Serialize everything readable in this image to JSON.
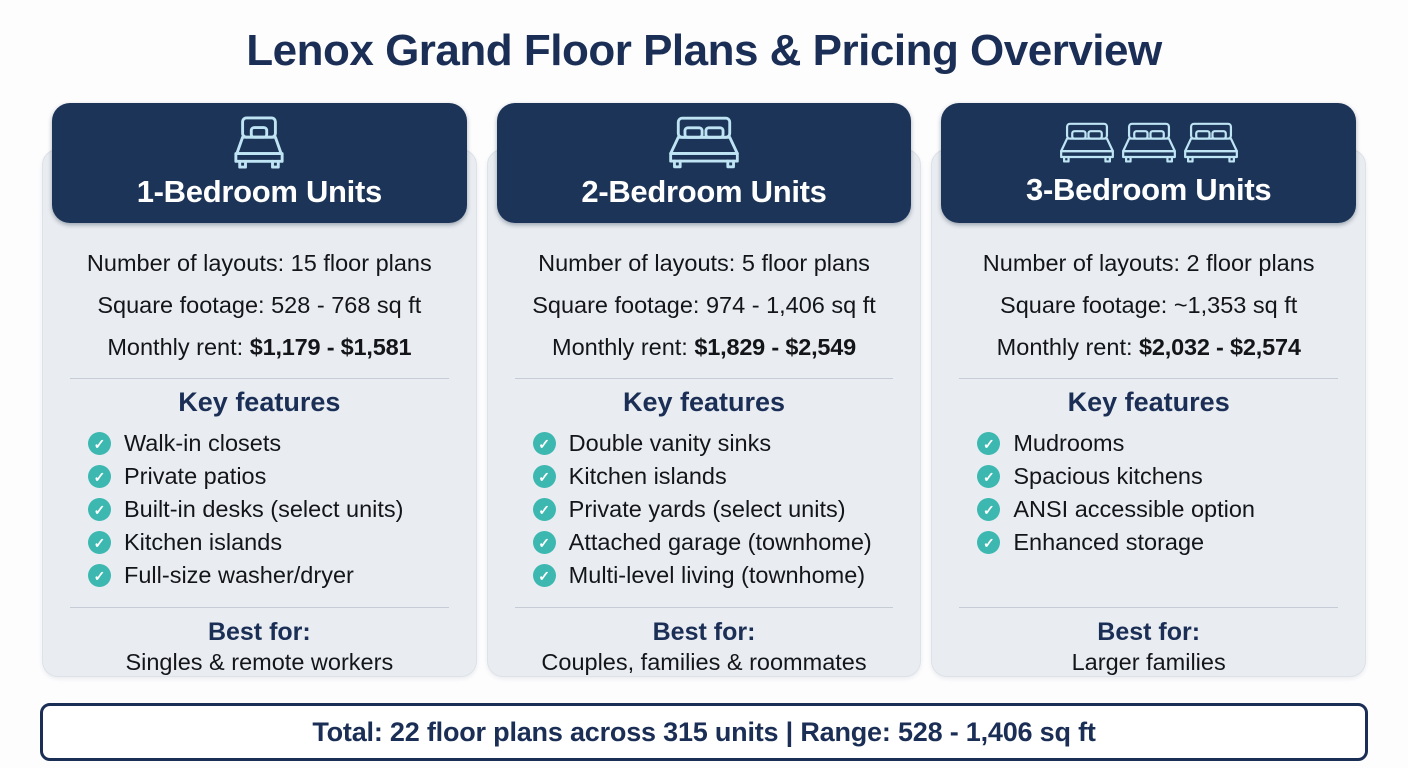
{
  "title": "Lenox Grand Floor Plans & Pricing Overview",
  "colors": {
    "navy_header": "#1c3458",
    "navy_text": "#1b2e55",
    "teal_check": "#3cb8b1",
    "panel_bg": "#e9edf2",
    "bed_icon_blue": "#bfe4f4",
    "page_bg": "#fdfdfe"
  },
  "icons": {
    "check": "✓"
  },
  "cards": [
    {
      "title": "1-Bedroom Units",
      "bed_icon": "single-bed-icon",
      "layouts": "Number of layouts: 15 floor plans",
      "sqft": "Square footage: 528 - 768 sq ft",
      "rent_label": "Monthly rent:",
      "rent_value": "$1,179 - $1,581",
      "features_title": "Key features",
      "features": [
        "Walk-in closets",
        "Private patios",
        "Built-in desks (select units)",
        "Kitchen islands",
        "Full-size washer/dryer"
      ],
      "best_for_label": "Best for:",
      "best_for": "Singles & remote workers"
    },
    {
      "title": "2-Bedroom Units",
      "bed_icon": "double-bed-icon",
      "layouts": "Number of layouts: 5 floor plans",
      "sqft": "Square footage: 974 - 1,406 sq ft",
      "rent_label": "Monthly rent:",
      "rent_value": "$1,829 - $2,549",
      "features_title": "Key features",
      "features": [
        "Double vanity sinks",
        "Kitchen islands",
        "Private yards (select units)",
        "Attached garage (townhome)",
        "Multi-level living (townhome)"
      ],
      "best_for_label": "Best for:",
      "best_for": "Couples, families & roommates"
    },
    {
      "title": "3-Bedroom Units",
      "bed_icon": "triple-bed-icon",
      "layouts": "Number of layouts: 2 floor plans",
      "sqft": "Square footage: ~1,353 sq ft",
      "rent_label": "Monthly rent:",
      "rent_value": "$2,032 - $2,574",
      "features_title": "Key features",
      "features": [
        "Mudrooms",
        "Spacious kitchens",
        "ANSI accessible option",
        "Enhanced storage"
      ],
      "best_for_label": "Best for:",
      "best_for": "Larger families"
    }
  ],
  "footer": {
    "total": "Total: 22 floor plans across 315 units | Range: 528 - 1,406 sq ft"
  }
}
